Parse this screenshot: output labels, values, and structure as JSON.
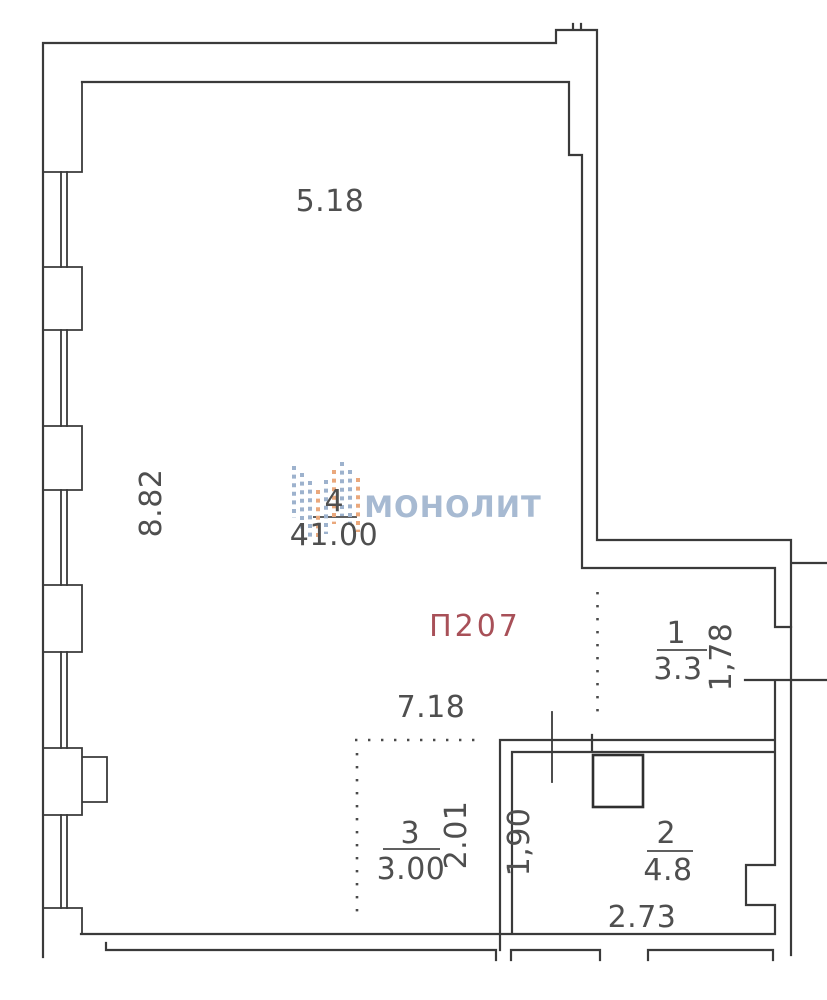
{
  "plan": {
    "apartment_number": "П207",
    "watermark": "МОНОЛИТ",
    "rooms": [
      {
        "number": "4",
        "area": "41.00"
      },
      {
        "number": "1",
        "area": "3.3"
      },
      {
        "number": "2",
        "area": "4.8"
      },
      {
        "number": "3",
        "area": "3.00"
      }
    ],
    "dimensions": {
      "top_width": "5.18",
      "left_height": "8.82",
      "mid_width": "7.18",
      "room1_depth": "1,78",
      "room2_width": "2.73",
      "room2_depth": "1,90",
      "room3_depth": "2.01"
    },
    "colors": {
      "line": "#3a3a3a",
      "dim_text": "#4f4f4f",
      "apartment_number": "#a85058",
      "watermark": "#a7bad2",
      "logo_blue": "#9db2cd",
      "logo_orange": "#eaa87c",
      "background": "#ffffff"
    }
  }
}
